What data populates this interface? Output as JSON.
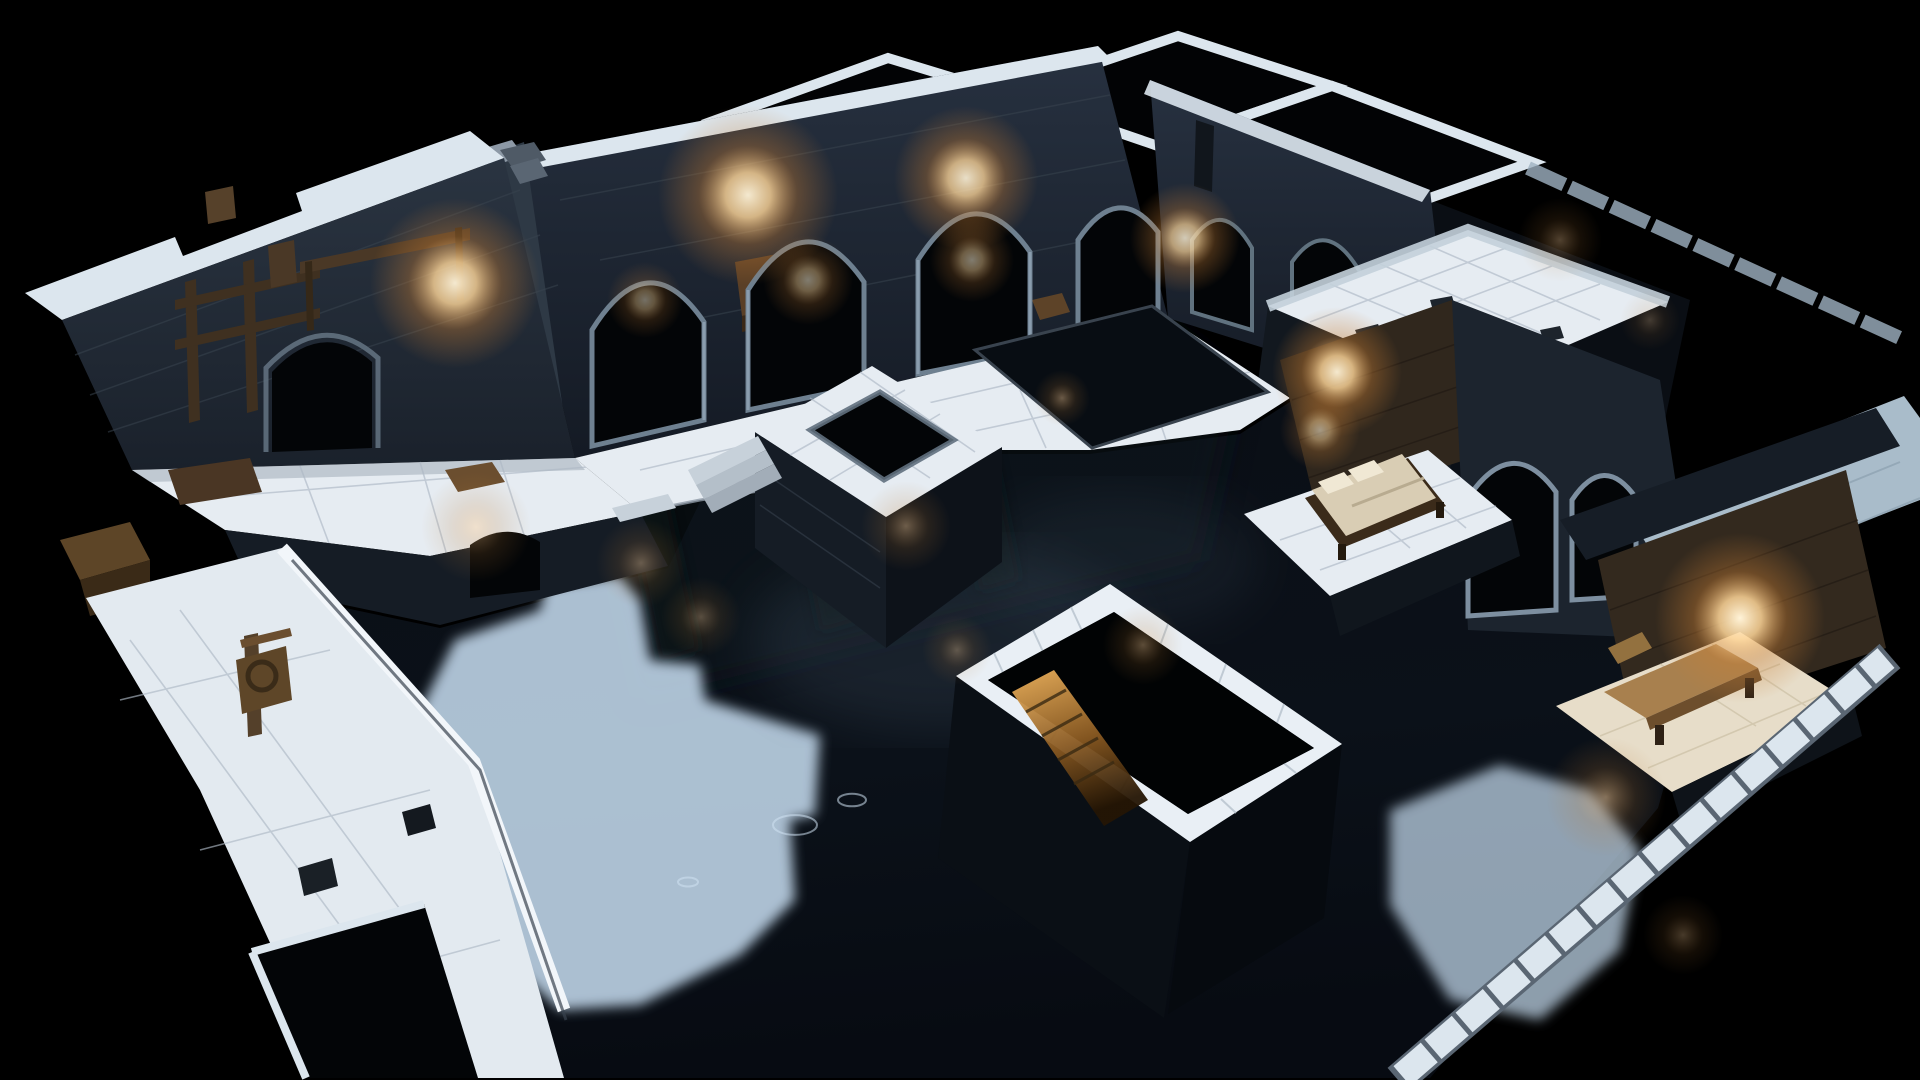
{
  "image": {
    "kind": "3d-isometric-dungeon-map-render",
    "background": "black-void"
  },
  "palette": {
    "background": "#000000",
    "wall-top": "#dce6ee",
    "wall-face": "#27313e",
    "floor": "#e6ecf2",
    "floor-grid": "#aeb9c4",
    "floor-cream": "#e7ddc9",
    "water": "#0a0e15",
    "patch": "#bdd3e6",
    "glow-core": "#fff3d8",
    "glow-mid": "#f0b45e",
    "wood-dark": "#3b2b1a",
    "wood-mid": "#6b4e2f",
    "wood-light": "#a8804e",
    "mattress": "#d9cdb4",
    "black": "#030507",
    "stone-rim": "#61707e"
  },
  "lights": {
    "wall_glows": [
      {
        "x": 455,
        "y": 283,
        "r": 85,
        "o": 0.95
      },
      {
        "x": 748,
        "y": 195,
        "r": 90,
        "o": 0.95
      },
      {
        "x": 966,
        "y": 178,
        "r": 72,
        "o": 0.9
      },
      {
        "x": 1185,
        "y": 238,
        "r": 55,
        "o": 0.8
      },
      {
        "x": 1337,
        "y": 372,
        "r": 65,
        "o": 0.95
      },
      {
        "x": 1740,
        "y": 618,
        "r": 85,
        "o": 1
      },
      {
        "x": 645,
        "y": 300,
        "r": 38,
        "o": 0.45
      },
      {
        "x": 808,
        "y": 280,
        "r": 45,
        "o": 0.5
      },
      {
        "x": 972,
        "y": 260,
        "r": 42,
        "o": 0.5
      },
      {
        "x": 1320,
        "y": 430,
        "r": 40,
        "o": 0.55
      }
    ],
    "water_reflections": [
      {
        "x": 476,
        "y": 527,
        "r": 55,
        "o": 0.5
      },
      {
        "x": 641,
        "y": 563,
        "r": 45,
        "o": 0.45
      },
      {
        "x": 701,
        "y": 617,
        "r": 40,
        "o": 0.4
      },
      {
        "x": 906,
        "y": 526,
        "r": 45,
        "o": 0.5
      },
      {
        "x": 957,
        "y": 650,
        "r": 35,
        "o": 0.4
      },
      {
        "x": 1143,
        "y": 645,
        "r": 40,
        "o": 0.45
      },
      {
        "x": 1606,
        "y": 797,
        "r": 60,
        "o": 0.6
      },
      {
        "x": 1683,
        "y": 935,
        "r": 40,
        "o": 0.35
      },
      {
        "x": 1560,
        "y": 240,
        "r": 42,
        "o": 0.4
      },
      {
        "x": 1650,
        "y": 320,
        "r": 30,
        "o": 0.3
      },
      {
        "x": 1062,
        "y": 398,
        "r": 28,
        "o": 0.5
      }
    ]
  },
  "water": {
    "ripples": [
      {
        "x": 795,
        "y": 825,
        "r": 22
      },
      {
        "x": 852,
        "y": 800,
        "r": 14
      },
      {
        "x": 1712,
        "y": 557,
        "r": 16
      },
      {
        "x": 1762,
        "y": 712,
        "r": 13
      },
      {
        "x": 688,
        "y": 882,
        "r": 10
      }
    ]
  },
  "inventory": [
    "outer-stone-walls",
    "arched-hall",
    "torch-glows",
    "flooded-basin",
    "central-well",
    "stair-pit",
    "bed-alcove",
    "bench-alcove",
    "terrace-platform",
    "tiled-walkway",
    "wooden-machinery",
    "doorway-arches",
    "crates",
    "pool"
  ]
}
